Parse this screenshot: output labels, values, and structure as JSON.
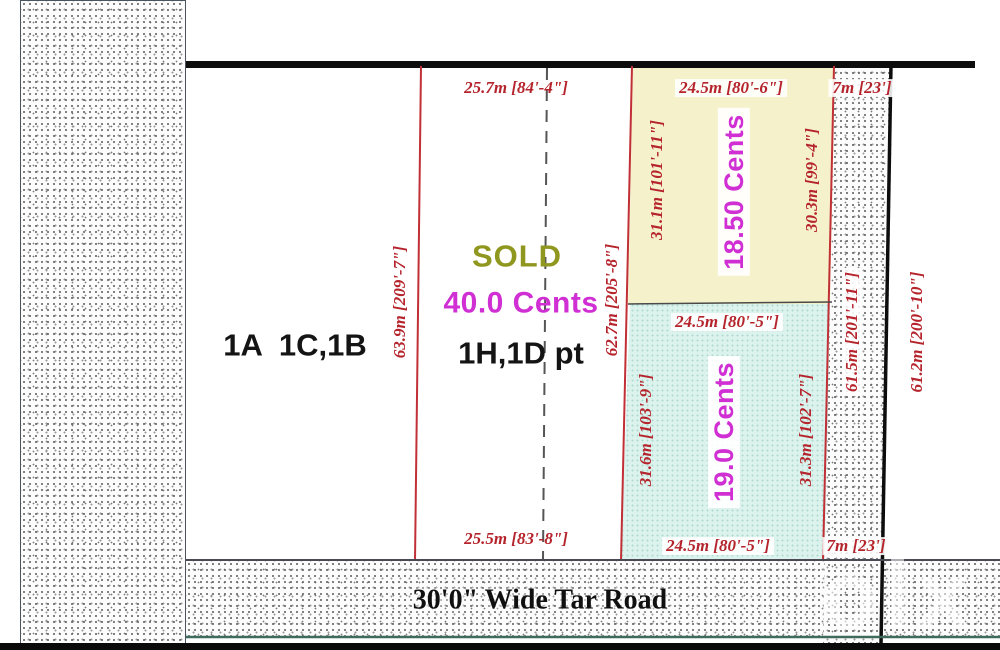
{
  "colors": {
    "red_dim": "#b5242c",
    "magenta": "#d02fd4",
    "sold_olive": "#8f971f",
    "yellow_fill": "#f5f2cb",
    "blue_fill": "#dcf2ec",
    "black_line": "#0d0d0d"
  },
  "left_band": {
    "label": "EXISTIN"
  },
  "road": {
    "label": "30'0\" Wide Tar Road"
  },
  "watermark": {
    "label": "olx"
  },
  "main_plot": {
    "top_dim": "25.7m [84'-4\"]",
    "bottom_dim": "25.5m [83'-8\"]",
    "left_dim": "63.9m [209'-7\"]",
    "right_dim": "62.7m [205'-8\"]",
    "status": "SOLD",
    "area": "40.0 Cents",
    "plot_id": "1H,1D pt",
    "neighbor_id": "1A  1C,1B"
  },
  "yellow_plot": {
    "top_dim": "24.5m [80'-6\"]",
    "left_dim": "31.1m [101'-11\"]",
    "right_dim": "30.3m [99'-4\"]",
    "area": "18.50 Cents"
  },
  "blue_plot": {
    "top_dim": "24.5m [80'-5\"]",
    "bottom_dim": "24.5m [80'-5\"]",
    "left_dim": "31.6m [103'-9\"]",
    "right_dim": "31.3m [102'-7\"]",
    "area": "19.0 Cents"
  },
  "strip": {
    "top_dim": "7m [23']",
    "bottom_dim": "7m [23']",
    "inner_dim": "61.5m [201'-11\"]",
    "outer_dim": "61.2m [200'-10\"]"
  }
}
